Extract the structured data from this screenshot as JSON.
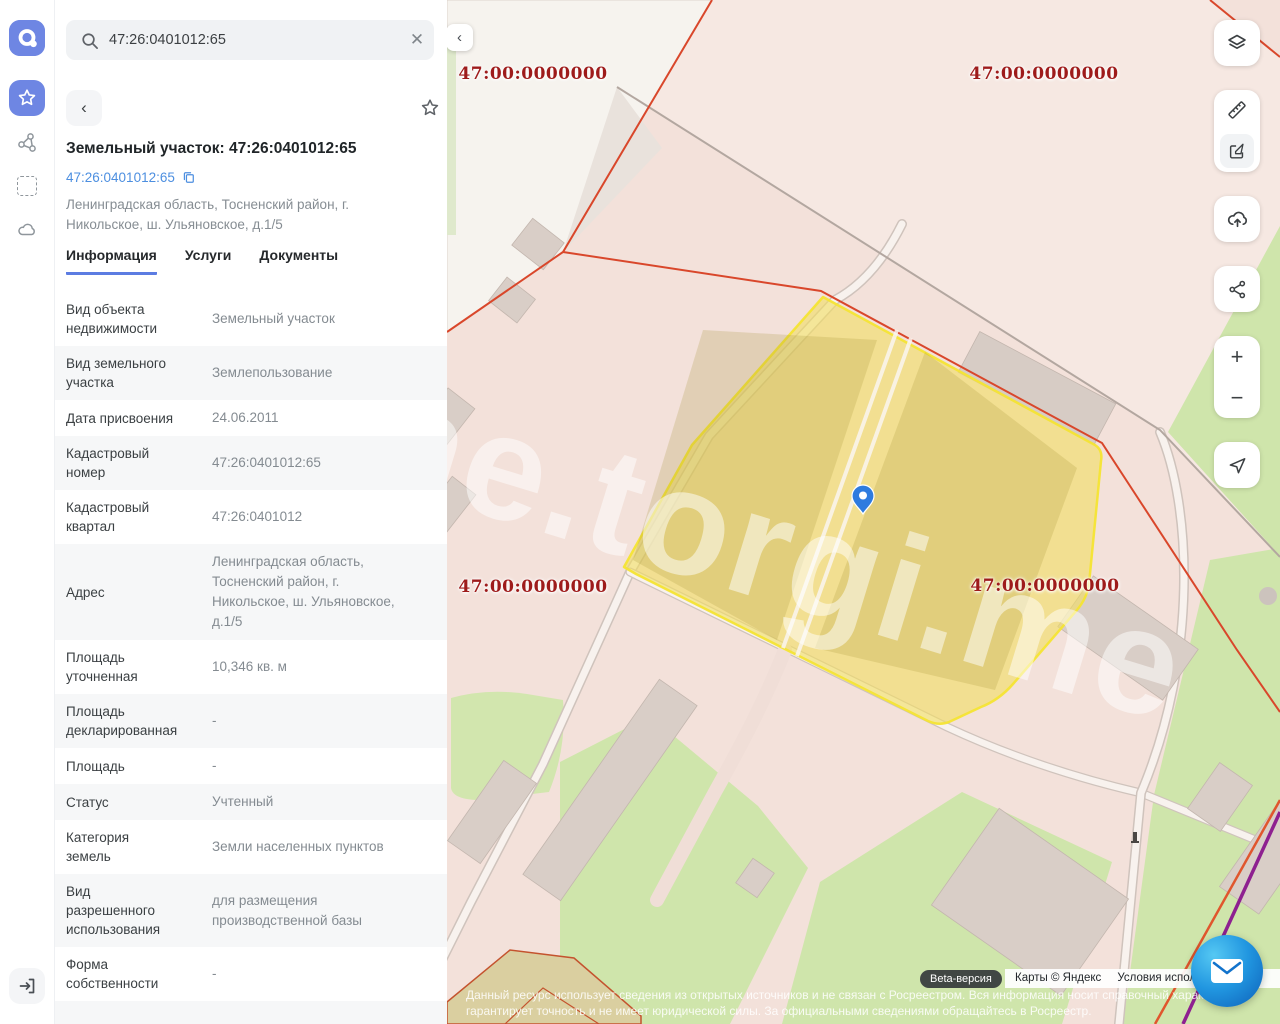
{
  "sidebar": {
    "logo_icon": "app-logo",
    "items": [
      {
        "icon": "star-icon",
        "active": true
      },
      {
        "icon": "graph-icon",
        "active": false
      },
      {
        "icon": "select-area-icon",
        "active": false
      },
      {
        "icon": "cloud-icon",
        "active": false
      }
    ],
    "exit_icon": "exit-icon"
  },
  "search": {
    "value": "47:26:0401012:65",
    "search_icon": "search-icon",
    "clear_icon": "close-icon"
  },
  "object_card": {
    "back_icon": "chevron-left-icon",
    "favorite_icon": "star-icon",
    "share_icon": "share-icon",
    "title": "Земельный участок: 47:26:0401012:65",
    "cadastral_link": "47:26:0401012:65",
    "copy_icon": "copy-icon",
    "address": "Ленинградская область, Тосненский район, г. Никольское, ш. Ульяновское, д.1/5",
    "tabs": [
      {
        "label": "Информация",
        "active": true
      },
      {
        "label": "Услуги",
        "active": false
      },
      {
        "label": "Документы",
        "active": false
      }
    ],
    "rows": [
      {
        "label": "Вид объекта недвижимости",
        "value": "Земельный участок"
      },
      {
        "label": "Вид земельного участка",
        "value": "Землепользование"
      },
      {
        "label": "Дата присвоения",
        "value": "24.06.2011"
      },
      {
        "label": "Кадастровый номер",
        "value": "47:26:0401012:65"
      },
      {
        "label": "Кадастровый квартал",
        "value": "47:26:0401012"
      },
      {
        "label": "Адрес",
        "value": "Ленинградская область, Тосненский район, г. Никольское, ш. Ульяновское, д.1/5"
      },
      {
        "label": "Площадь уточненная",
        "value": "10,346 кв. м"
      },
      {
        "label": "Площадь декларированная",
        "value": "-"
      },
      {
        "label": "Площадь",
        "value": "-"
      },
      {
        "label": "Статус",
        "value": "Учтенный"
      },
      {
        "label": "Категория земель",
        "value": "Земли населенных пунктов"
      },
      {
        "label": "Вид разрешенного использования",
        "value": "для размещения производственной базы"
      },
      {
        "label": "Форма собственности",
        "value": "-"
      }
    ]
  },
  "map": {
    "collapse_icon": "chevron-left-icon",
    "quarter_labels": [
      "47:00:0000000",
      "47:00:0000000",
      "47:00:0000000",
      "47:00:0000000"
    ],
    "watermark": "ne.torgi.me",
    "beta_badge": "Beta-версия",
    "copyright": "Карты © Яндекс",
    "terms_link": "Условия использования",
    "disclaimer_line1": "Данный ресурс использует сведения из открытых источников и не связан с Росреестром. Вся информация носит справочный характер",
    "disclaimer_line2": "гарантирует точность и не имеет юридической силы. За официальными сведениями обращайтесь в Росреестр.",
    "pin_icon": "map-pin-icon",
    "colors": {
      "selected_parcel_fill": "#f1dd60",
      "selected_parcel_stroke": "#f4e434",
      "cadastral_line": "#d9472b",
      "quarter_label_text": "#9e1b1b",
      "pin_blue": "#2e7bdf",
      "map_base": "#f3e1da",
      "greenery": "#cfe5ab"
    }
  },
  "map_controls": {
    "layers_icon": "layers-icon",
    "ruler_icon": "ruler-icon",
    "edit_icon": "edit-icon",
    "upload_icon": "cloud-upload-icon",
    "share_icon": "share-icon",
    "zoom_in_label": "+",
    "zoom_out_label": "−",
    "locate_icon": "navigate-arrow-icon"
  },
  "chat": {
    "icon": "envelope-icon"
  }
}
